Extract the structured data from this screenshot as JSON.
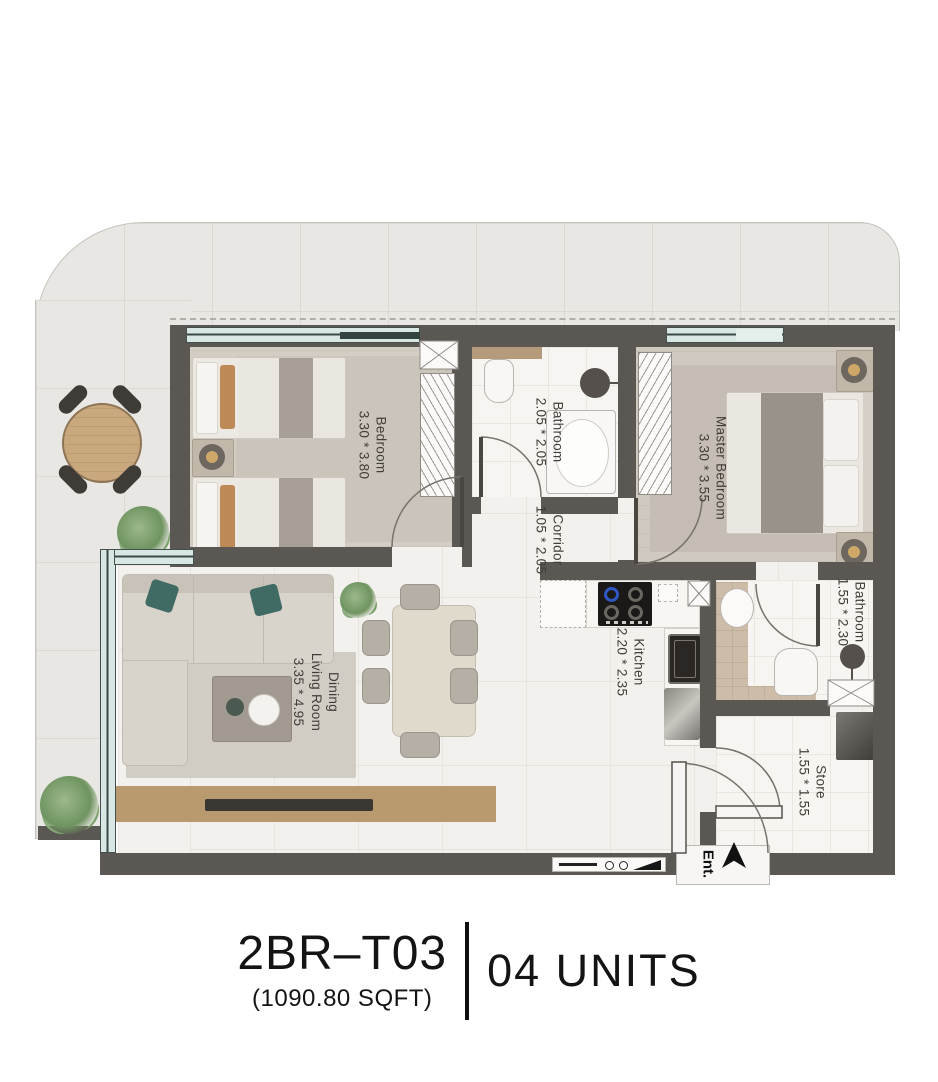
{
  "title": {
    "unit_code": "2BR–T03",
    "area": "(1090.80 SQFT)",
    "units": "04 UNITS"
  },
  "entrance": {
    "label": "Ent."
  },
  "rooms": [
    {
      "key": "bedroom",
      "name": "Bedroom",
      "dims": "3.30 * 3.80"
    },
    {
      "key": "bathroom-1",
      "name": "Bathroom",
      "dims": "2.05 * 2.05"
    },
    {
      "key": "corridor",
      "name": "Corridor",
      "dims": "1.05 * 2.05"
    },
    {
      "key": "master-bedroom",
      "name": "Master Bedroom",
      "dims": "3.30 * 3.55"
    },
    {
      "key": "kitchen",
      "name": "Kitchen",
      "dims": "2.20 * 2.35"
    },
    {
      "key": "bathroom-2",
      "name": "Bathroom",
      "dims": "1.55 * 2.30"
    },
    {
      "key": "dining-living",
      "name_line1": "Dining",
      "name_line2": "Living Room",
      "dims": "3.35 * 4.95"
    },
    {
      "key": "store",
      "name": "Store",
      "dims": "1.55 * 1.55"
    }
  ],
  "colors": {
    "wall": "#5b5753",
    "balcony_tile": "#e9e7e3",
    "interior_floor": "#f3f1ed",
    "window_glass": "#d8e7e3",
    "wood": "#b9996e",
    "pillow_accent": "#bd8a57",
    "sofa_pillow": "#3f6b64",
    "label_text": "#413d38",
    "title_text": "#141414"
  }
}
